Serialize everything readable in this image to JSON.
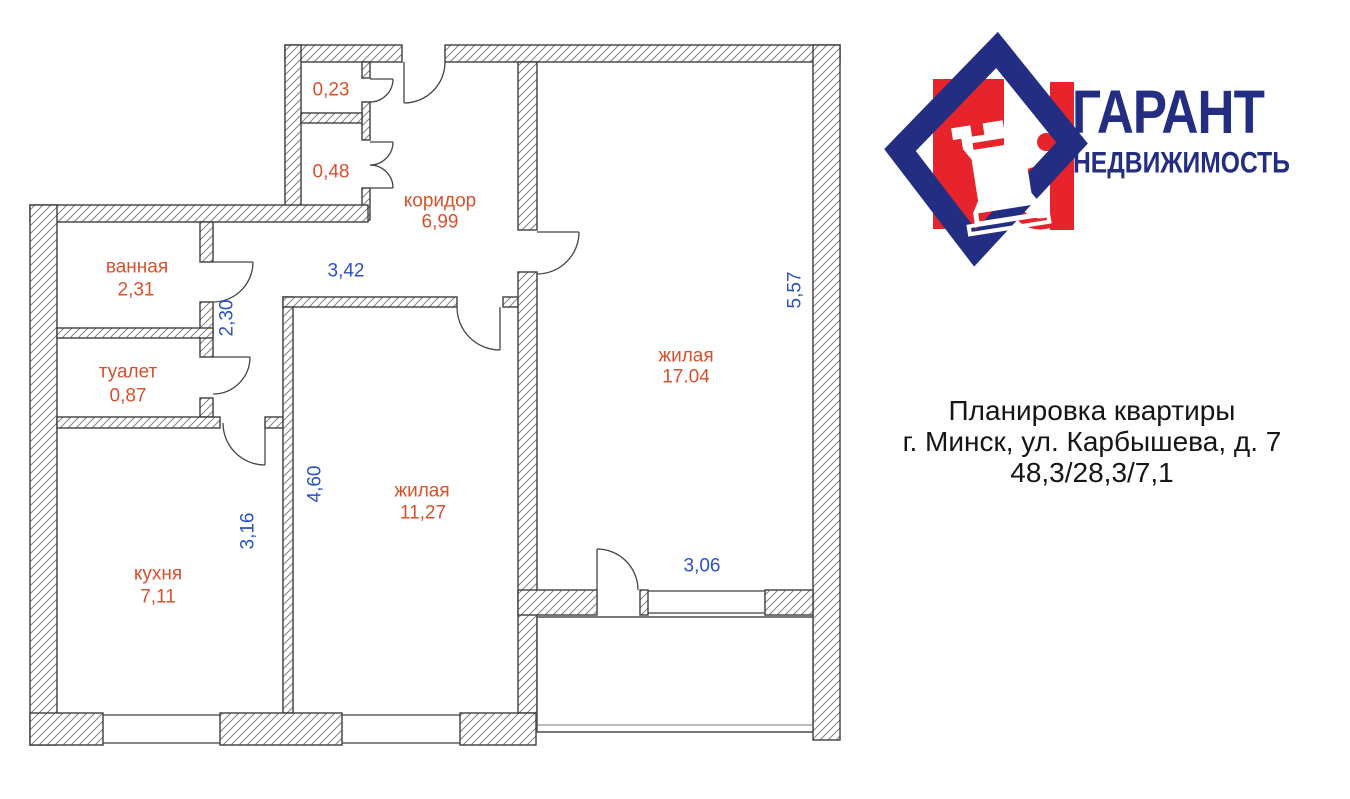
{
  "brand": {
    "title": "ГАРАНТ",
    "subtitle": "НЕДВИЖИМОСТЬ",
    "navy": "#232e82",
    "red": "#e7242b"
  },
  "icons": {
    "rook_glyph": "♜"
  },
  "caption": {
    "line1": "Планировка квартиры",
    "line2": "г. Минск, ул. Карбышева, д. 7",
    "line3": "48,3/28,3/7,1"
  },
  "colors": {
    "room_label": "#d8512c",
    "dimension": "#2b50c6",
    "wall_stroke": "#3f3f3f",
    "hatch": "#828282"
  },
  "rooms": {
    "closet_top": {
      "area": "0,23"
    },
    "closet_bottom": {
      "area": "0,48"
    },
    "corridor": {
      "name": "коридор",
      "area": "6,99"
    },
    "bathroom": {
      "name": "ванная",
      "area": "2,31"
    },
    "toilet": {
      "name": "туалет",
      "area": "0,87"
    },
    "kitchen": {
      "name": "кухня",
      "area": "7,11"
    },
    "living_small": {
      "name": "жилая",
      "area": "11,27"
    },
    "living_large": {
      "name": "жилая",
      "area": "17.04"
    }
  },
  "dimensions": {
    "hall_width": "3,42",
    "hall_height": "2,30",
    "kitchen_height": "3,16",
    "living_small_height": "4,60",
    "living_large_height": "5,57",
    "living_large_width": "3,06"
  }
}
